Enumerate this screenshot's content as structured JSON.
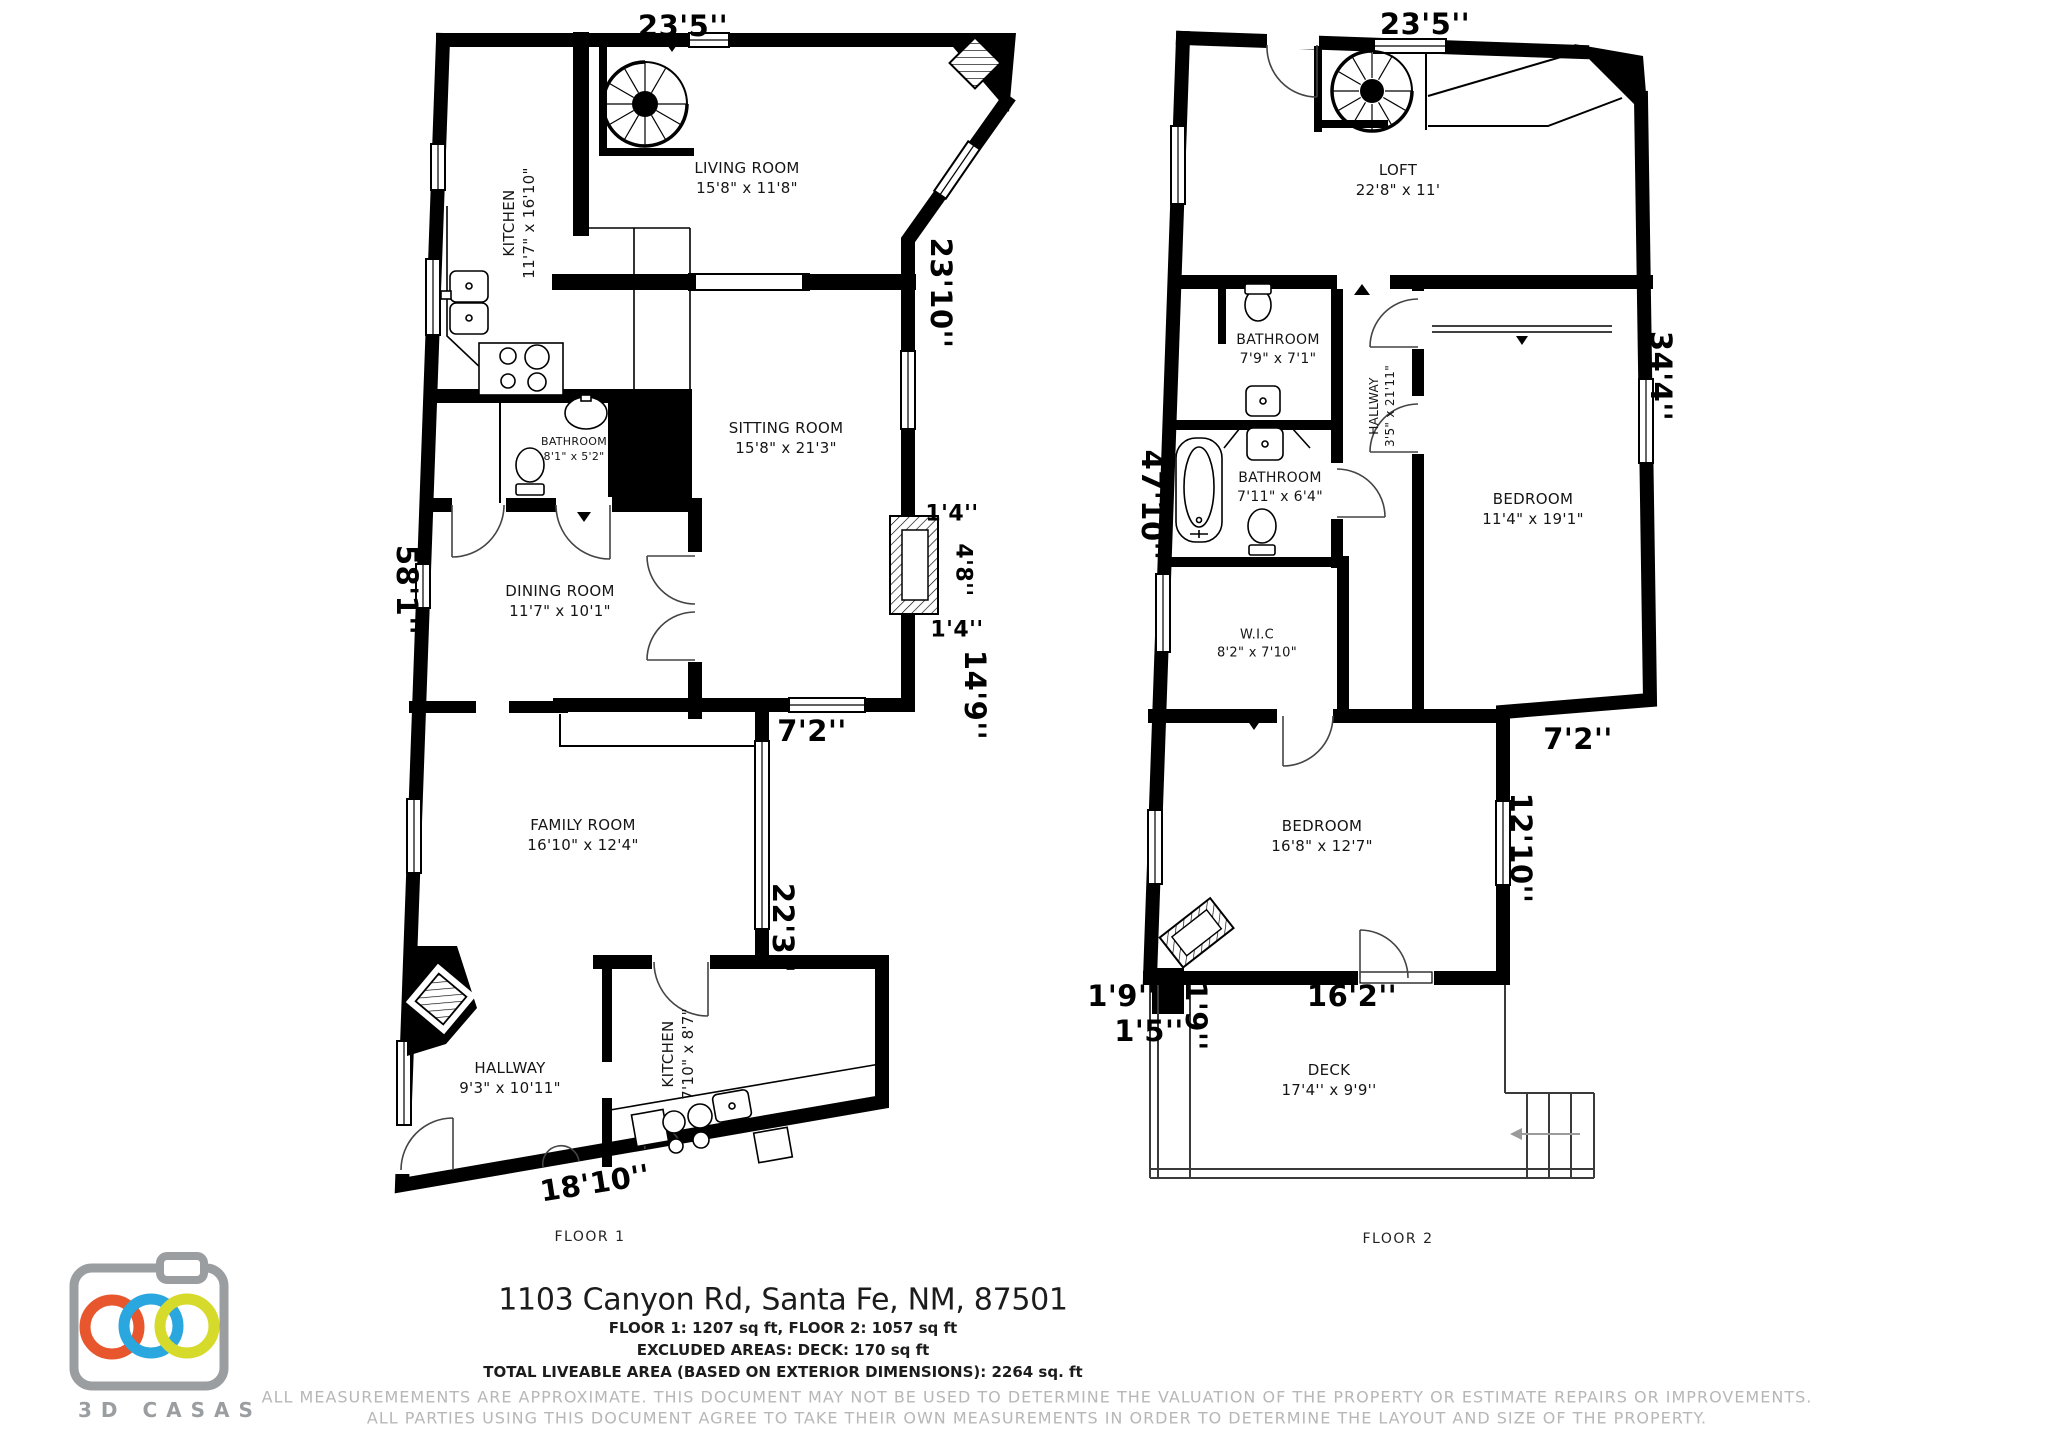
{
  "page": {
    "address": "1103 Canyon Rd, Santa Fe, NM, 87501",
    "area_line1": "FLOOR 1: 1207 sq ft, FLOOR 2: 1057 sq ft",
    "area_line2": "EXCLUDED AREAS: DECK: 170 sq ft",
    "area_line3": "TOTAL LIVEABLE AREA (BASED ON EXTERIOR DIMENSIONS): 2264 sq. ft",
    "disclaimer1": "ALL MEASUREMEMENTS ARE APPROXIMATE. THIS DOCUMENT MAY NOT BE USED TO DETERMINE THE VALUATION OF THE PROPERTY OR ESTIMATE REPAIRS OR IMPROVEMENTS.",
    "disclaimer2": "ALL PARTIES USING THIS DOCUMENT AGREE TO TAKE THEIR OWN MEASUREMENTS IN ORDER TO DETERMINE THE LAYOUT AND SIZE OF THE PROPERTY."
  },
  "logo": {
    "brand": "3D CASAS",
    "colors": {
      "body": "#9b9ea1",
      "orange": "#e8562d",
      "blue": "#2aa7de",
      "yellow": "#d6da2a"
    }
  },
  "floor1": {
    "caption": "FLOOR 1",
    "rooms": {
      "kitchen_top": {
        "name": "KITCHEN",
        "dims": "11'7\" x 16'10\""
      },
      "living": {
        "name": "LIVING ROOM",
        "dims": "15'8\" x 11'8\""
      },
      "sitting": {
        "name": "SITTING ROOM",
        "dims": "15'8\" x 21'3\""
      },
      "bathroom": {
        "name": "BATHROOM",
        "dims": "8'1\" x 5'2\""
      },
      "dining": {
        "name": "DINING ROOM",
        "dims": "11'7\" x 10'1\""
      },
      "family": {
        "name": "FAMILY ROOM",
        "dims": "16'10\" x 12'4\""
      },
      "hallway": {
        "name": "HALLWAY",
        "dims": "9'3\" x 10'11\""
      },
      "kitchen_bottom": {
        "name": "KITCHEN",
        "dims": "7'10\" x 8'7\""
      }
    },
    "dims": {
      "top": "23'5''",
      "right_upper": "23'10''",
      "fireplace_top": "1'4''",
      "fireplace_side": "4'8''",
      "fireplace_bottom": "1'4''",
      "right_mid": "14'9''",
      "sitting_bottom": "7'2''",
      "right_lower": "22'3''",
      "left": "58'1''",
      "bottom": "18'10''"
    }
  },
  "floor2": {
    "caption": "FLOOR 2",
    "rooms": {
      "loft": {
        "name": "LOFT",
        "dims": "22'8\" x 11'"
      },
      "bathroom_upper": {
        "name": "BATHROOM",
        "dims": "7'9\" x 7'1\""
      },
      "hallway": {
        "name": "HALLWAY",
        "dims": "3'5\" x 21'11\""
      },
      "bathroom_lower": {
        "name": "BATHROOM",
        "dims": "7'11\" x 6'4\""
      },
      "bedroom_right": {
        "name": "BEDROOM",
        "dims": "11'4\" x 19'1\""
      },
      "wic": {
        "name": "W.I.C",
        "dims": "8'2\" x 7'10\""
      },
      "bedroom_lower": {
        "name": "BEDROOM",
        "dims": "16'8\" x 12'7\""
      },
      "deck": {
        "name": "DECK",
        "dims": "17'4'' x 9'9''"
      }
    },
    "dims": {
      "top": "23'5''",
      "right_upper": "34'4''",
      "left": "47'10''",
      "step": "7'2''",
      "right_lower": "12'10''",
      "bottom": "16'2''",
      "offset_left": "1'9''",
      "offset_bottom": "1'5''",
      "offset_inner": "1'9''"
    }
  }
}
